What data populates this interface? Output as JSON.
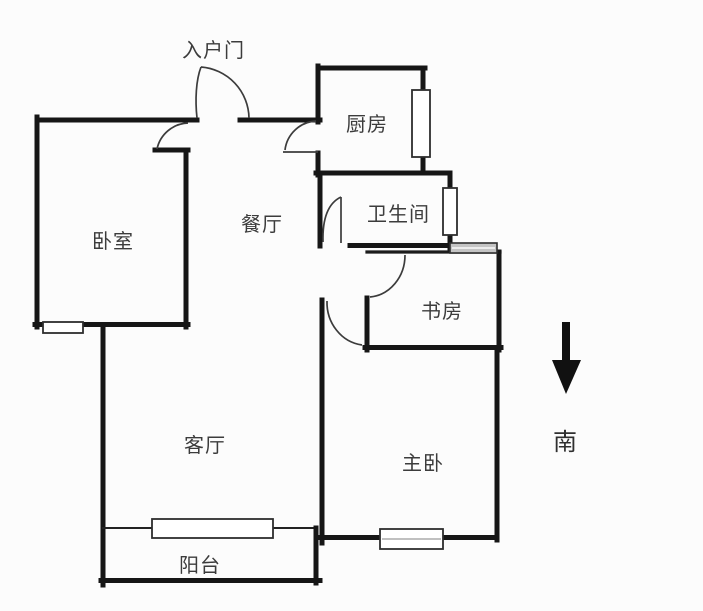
{
  "floor_plan": {
    "labels": {
      "entry_door": "入户门",
      "kitchen": "厨房",
      "bathroom": "卫生间",
      "study": "书房",
      "dining": "餐厅",
      "bedroom": "卧室",
      "living_room": "客厅",
      "master_bedroom": "主卧",
      "balcony": "阳台",
      "south": "南"
    },
    "colors": {
      "wall": "#161616",
      "door_arc": "#3c3c3c",
      "text": "#3c3c3c",
      "background": "#fcfcfc",
      "window_gray": "#c4c4c4"
    }
  }
}
